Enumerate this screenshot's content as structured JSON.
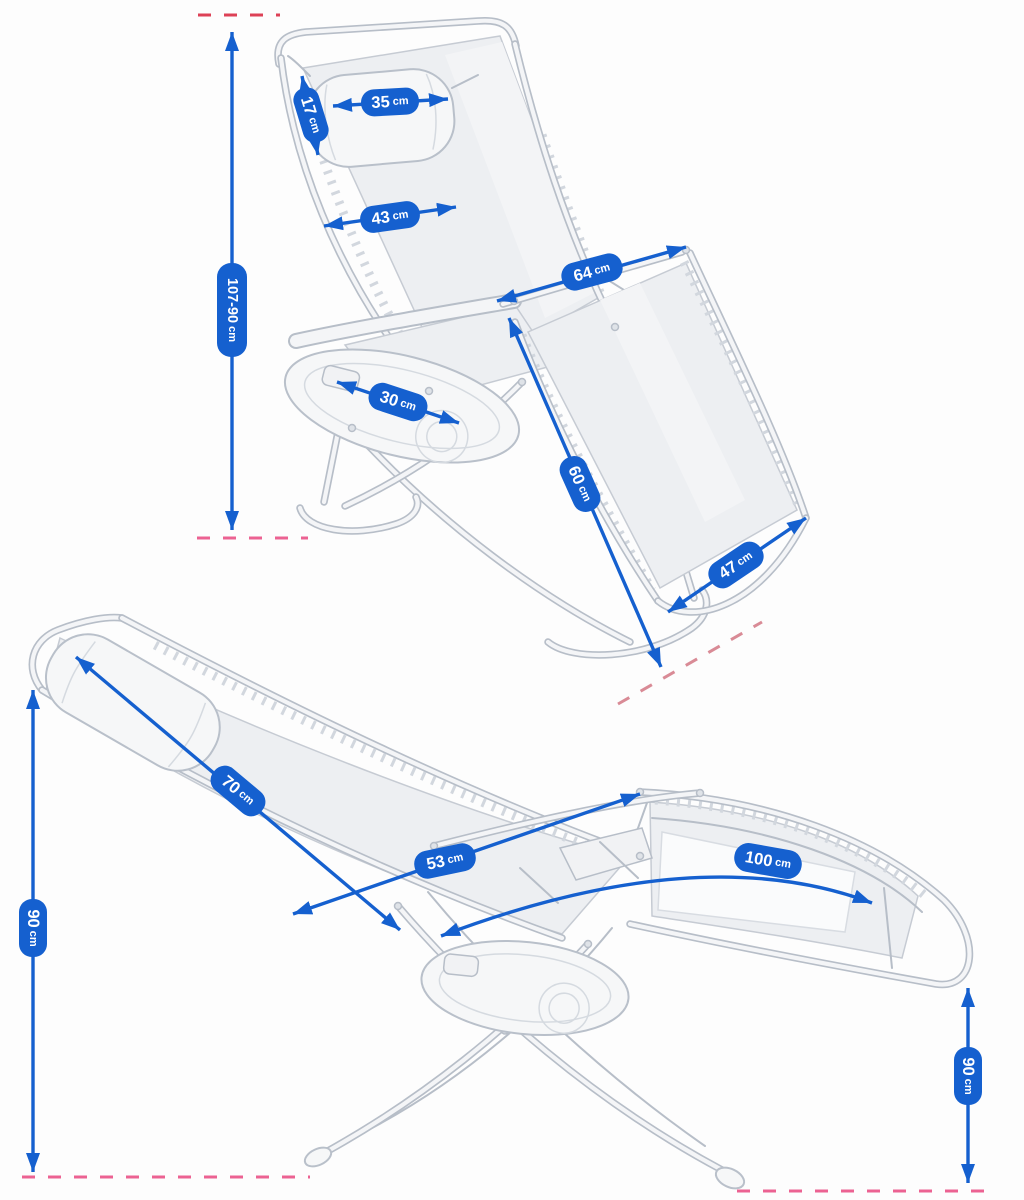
{
  "colors": {
    "dimension_blue": "#1560cf",
    "dash_red": "#dd4156",
    "dash_pink": "#ec6292",
    "dash_rose": "#d98b96",
    "chair_line_gray": "#b7bec8"
  },
  "views": {
    "upright": {
      "dims": {
        "headrest_width": {
          "value": "35",
          "unit": "cm"
        },
        "headrest_height": {
          "value": "17",
          "unit": "cm"
        },
        "backrest_width": {
          "value": "43",
          "unit": "cm"
        },
        "overall_height": {
          "value": "107-90",
          "unit": "cm"
        },
        "armrest_length": {
          "value": "64",
          "unit": "cm"
        },
        "tray_width": {
          "value": "30",
          "unit": "cm"
        },
        "seat_diagonal": {
          "value": "60",
          "unit": "cm"
        },
        "legrest_width": {
          "value": "47",
          "unit": "cm"
        }
      }
    },
    "reclined": {
      "dims": {
        "backrest_length": {
          "value": "70",
          "unit": "cm"
        },
        "seat_length": {
          "value": "53",
          "unit": "cm"
        },
        "legrest_length": {
          "value": "100",
          "unit": "cm"
        },
        "height_left": {
          "value": "90",
          "unit": "cm"
        },
        "height_right": {
          "value": "90",
          "unit": "cm"
        }
      }
    }
  }
}
